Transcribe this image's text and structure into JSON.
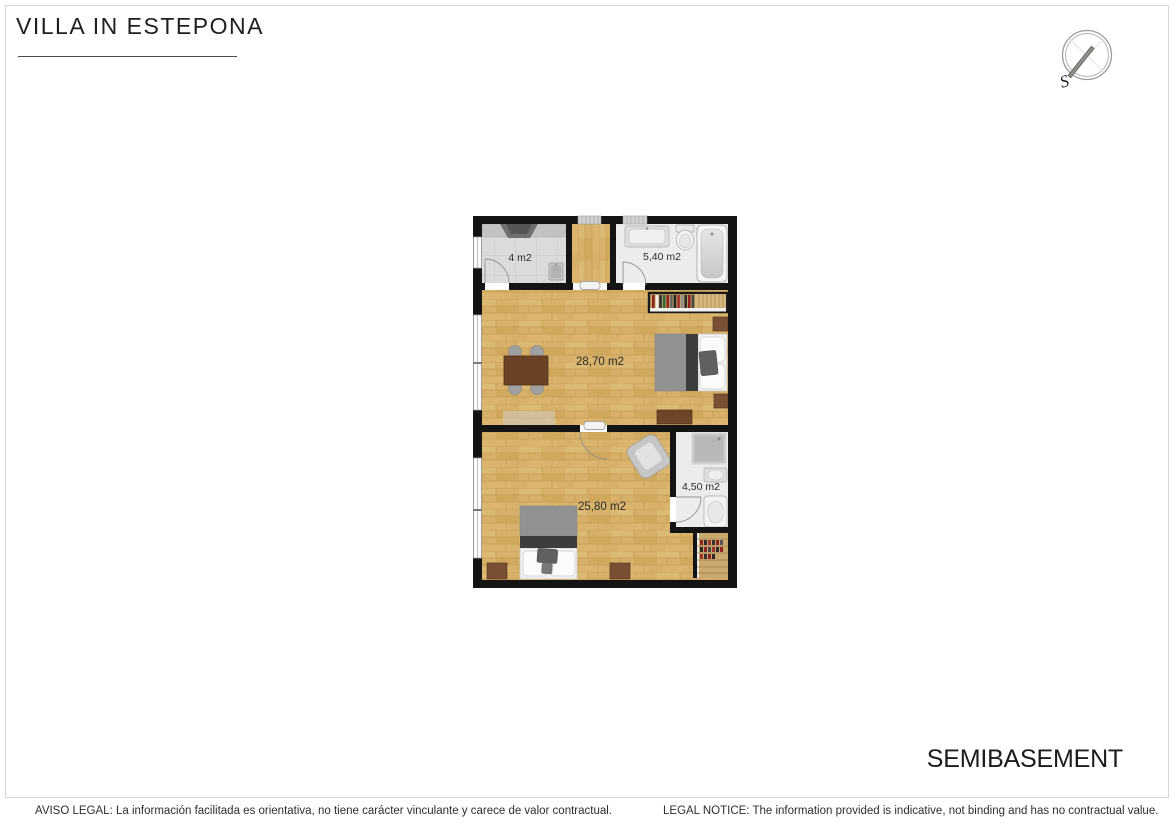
{
  "header": {
    "title": "VILLA IN ESTEPONA"
  },
  "compass": {
    "south_label": "S"
  },
  "floor_plan": {
    "floor_label": "SEMIBASEMENT",
    "rooms": [
      {
        "name": "kitchen",
        "area_label": "4 m2"
      },
      {
        "name": "bathroom-top",
        "area_label": "5,40 m2"
      },
      {
        "name": "living-bedroom",
        "area_label": "28,70 m2"
      },
      {
        "name": "bedroom",
        "area_label": "25,80 m2"
      },
      {
        "name": "bathroom-bottom",
        "area_label": "4,50 m2"
      }
    ]
  },
  "footer": {
    "aviso_legal": "AVISO LEGAL: La información facilitada es orientativa, no tiene carácter vinculante y carece de valor contractual.",
    "legal_notice": "LEGAL NOTICE: The information provided is indicative, not binding and has no contractual value."
  },
  "colors": {
    "wall": "#141414",
    "wood_floor": "#D7B169",
    "tile_floor": "#DBDBD9",
    "bath_floor": "#ECECEA",
    "furniture_brown": "#7B4F33",
    "label_text": "#2B2B2B"
  }
}
